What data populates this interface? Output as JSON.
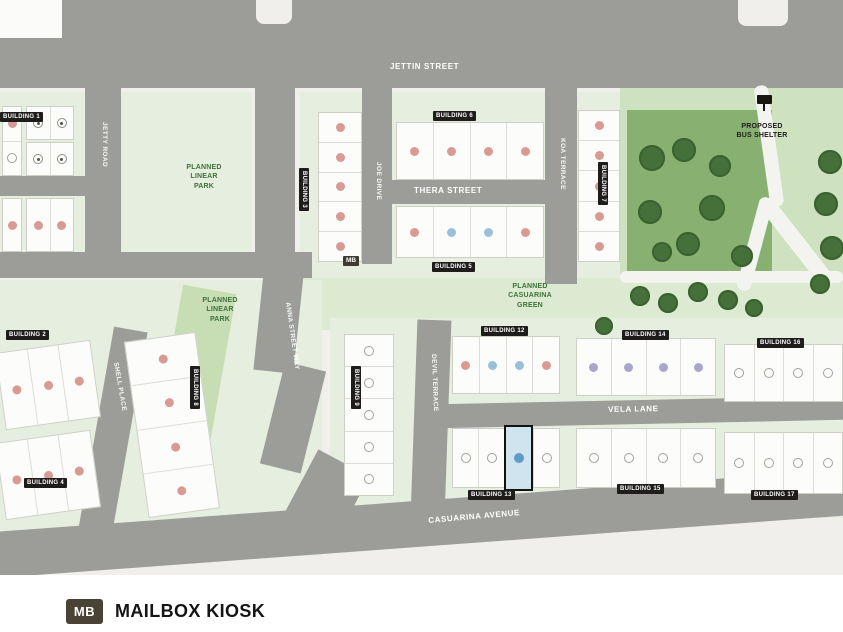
{
  "title": "Community site plan",
  "colors": {
    "road": "#9c9c99",
    "background": "#f0efec",
    "residential_block": "#e6efdf",
    "green_band": "#dcead2",
    "park_light": "#cfe2bf",
    "park_dark": "#87b071",
    "tree": "#45703a",
    "linear_park_strip": "#c7ddb3",
    "unit_red": "#d89a93",
    "unit_blue": "#9abfd9",
    "unit_purple": "#a9a6cd",
    "selected_fill": "#cfe4ee",
    "selected_dot": "#5f9cc4",
    "chip_bg": "#1e1d1b",
    "green_text": "#3c7239"
  },
  "map": {
    "street_labels": [
      {
        "text": "JETTIN STREET",
        "x": 390,
        "y": 63,
        "rot": 0,
        "size": "lg"
      },
      {
        "text": "THERA STREET",
        "x": 414,
        "y": 187,
        "rot": 0,
        "size": "lg"
      },
      {
        "text": "VELA LANE",
        "x": 608,
        "y": 406,
        "rot": -1,
        "size": "lg"
      },
      {
        "text": "CASUARINA AVENUE",
        "x": 428,
        "y": 517,
        "rot": -5,
        "size": "lg"
      },
      {
        "text": "JETTY ROAD",
        "x": 107,
        "y": 122,
        "rot": 90,
        "size": "sm"
      },
      {
        "text": "ANNA STREET WAY",
        "x": 290,
        "y": 302,
        "rot": 82,
        "size": "sm"
      },
      {
        "text": "JOE DRIVE",
        "x": 381,
        "y": 162,
        "rot": 90,
        "size": "sm"
      },
      {
        "text": "KOA TERRACE",
        "x": 565,
        "y": 138,
        "rot": 90,
        "size": "sm"
      },
      {
        "text": "DEVIL TERRACE",
        "x": 436,
        "y": 354,
        "rot": 88,
        "size": "sm"
      },
      {
        "text": "SHELL PLACE",
        "x": 118,
        "y": 362,
        "rot": 80,
        "size": "sm"
      }
    ],
    "area_labels": [
      {
        "text": "PLANNED\nLINEAR\nPARK",
        "x": 172,
        "y": 163,
        "w": 64,
        "color": "green"
      },
      {
        "text": "PLANNED\nLINEAR\nPARK",
        "x": 188,
        "y": 296,
        "w": 64,
        "color": "green"
      },
      {
        "text": "PLANNED\nCASUARINA\nGREEN",
        "x": 492,
        "y": 282,
        "w": 76,
        "color": "green"
      },
      {
        "text": "PROPOSED\nBUS SHELTER",
        "x": 726,
        "y": 122,
        "w": 72,
        "color": "black"
      }
    ],
    "buildings": [
      {
        "x": 2,
        "y": 106,
        "w": 20,
        "h": 70,
        "o": "v",
        "units": [
          "red",
          "open"
        ]
      },
      {
        "x": 26,
        "y": 106,
        "w": 48,
        "h": 34,
        "o": "h",
        "units": [
          "sym",
          "sym"
        ]
      },
      {
        "x": 26,
        "y": 142,
        "w": 48,
        "h": 34,
        "o": "h",
        "units": [
          "sym",
          "sym"
        ]
      },
      {
        "x": 2,
        "y": 198,
        "w": 20,
        "h": 54,
        "o": "v",
        "units": [
          "red"
        ]
      },
      {
        "x": 26,
        "y": 198,
        "w": 48,
        "h": 54,
        "o": "h",
        "units": [
          "red",
          "red"
        ],
        "chip": {
          "text": "BUILDING 1",
          "x": 0,
          "y": 112,
          "rot": 0
        }
      },
      {
        "x": 318,
        "y": 112,
        "w": 44,
        "h": 150,
        "o": "v",
        "units": [
          "red",
          "red",
          "red",
          "red",
          "red"
        ],
        "chip": {
          "text": "BUILDING 3",
          "x": 309,
          "y": 168,
          "rot": 90
        }
      },
      {
        "x": 396,
        "y": 122,
        "w": 148,
        "h": 58,
        "o": "h",
        "units": [
          "red",
          "red",
          "red",
          "red"
        ],
        "chip": {
          "text": "BUILDING 6",
          "x": 433,
          "y": 111,
          "rot": 0
        }
      },
      {
        "x": 396,
        "y": 206,
        "w": 148,
        "h": 52,
        "o": "h",
        "units": [
          "red",
          "blue",
          "blue",
          "red"
        ],
        "chip": {
          "text": "BUILDING 5",
          "x": 432,
          "y": 262,
          "rot": 0
        }
      },
      {
        "x": 578,
        "y": 110,
        "w": 42,
        "h": 152,
        "o": "v",
        "units": [
          "red",
          "red",
          "red",
          "red",
          "red"
        ],
        "chip": {
          "text": "BUILDING 7",
          "x": 608,
          "y": 162,
          "rot": 90
        }
      },
      {
        "x": 344,
        "y": 334,
        "w": 50,
        "h": 162,
        "o": "v",
        "units": [
          "open",
          "open",
          "open",
          "open",
          "open"
        ],
        "chip": {
          "text": "BUILDING 9",
          "x": 361,
          "y": 366,
          "rot": 90
        }
      },
      {
        "x": 452,
        "y": 336,
        "w": 108,
        "h": 58,
        "o": "h",
        "units": [
          "red",
          "blue",
          "blue",
          "red"
        ],
        "chip": {
          "text": "BUILDING 12",
          "x": 481,
          "y": 326,
          "rot": 0
        }
      },
      {
        "x": 452,
        "y": 428,
        "w": 108,
        "h": 60,
        "o": "h",
        "units": [
          "open",
          "open",
          "sel",
          "open"
        ],
        "chip": {
          "text": "BUILDING 13",
          "x": 468,
          "y": 490,
          "rot": 0
        }
      },
      {
        "x": 576,
        "y": 338,
        "w": 140,
        "h": 58,
        "o": "h",
        "units": [
          "purple",
          "purple",
          "purple",
          "purple"
        ],
        "chip": {
          "text": "BUILDING 14",
          "x": 622,
          "y": 330,
          "rot": 0
        }
      },
      {
        "x": 724,
        "y": 344,
        "w": 119,
        "h": 58,
        "o": "h",
        "units": [
          "open",
          "open",
          "open",
          "open"
        ],
        "chip": {
          "text": "BUILDING 16",
          "x": 757,
          "y": 338,
          "rot": 0
        }
      },
      {
        "x": 576,
        "y": 428,
        "w": 140,
        "h": 60,
        "o": "h",
        "units": [
          "open",
          "open",
          "open",
          "open"
        ],
        "chip": {
          "text": "BUILDING 15",
          "x": 617,
          "y": 484,
          "rot": 0
        }
      },
      {
        "x": 724,
        "y": 432,
        "w": 119,
        "h": 62,
        "o": "h",
        "units": [
          "open",
          "open",
          "open",
          "open"
        ],
        "chip": {
          "text": "BUILDING 17",
          "x": 751,
          "y": 490,
          "rot": 0
        }
      },
      {
        "x": 0,
        "y": 346,
        "w": 96,
        "h": 78,
        "o": "h",
        "rot": -8,
        "units": [
          "red",
          "red",
          "red"
        ],
        "chip": {
          "text": "BUILDING 2",
          "x": 6,
          "y": 330,
          "rot": 0
        }
      },
      {
        "x": 0,
        "y": 436,
        "w": 96,
        "h": 78,
        "o": "h",
        "rot": -8,
        "units": [
          "red",
          "red",
          "red"
        ],
        "chip": {
          "text": "BUILDING 4",
          "x": 24,
          "y": 478,
          "rot": 0
        }
      },
      {
        "x": 136,
        "y": 336,
        "w": 72,
        "h": 178,
        "o": "v",
        "rot": -8,
        "units": [
          "red",
          "red",
          "red",
          "red"
        ],
        "chip": {
          "text": "BUILDING 8",
          "x": 200,
          "y": 366,
          "rot": 90
        }
      }
    ],
    "markers": {
      "mailbox_kiosk_map_chip": {
        "label": "MB",
        "x": 343,
        "y": 256
      },
      "bus_shelter": {
        "label": "PROPOSED\nBUS SHELTER",
        "icon_x": 757,
        "icon_y": 95
      }
    }
  },
  "legend": {
    "badge": "MB",
    "label": "MAILBOX KIOSK"
  }
}
